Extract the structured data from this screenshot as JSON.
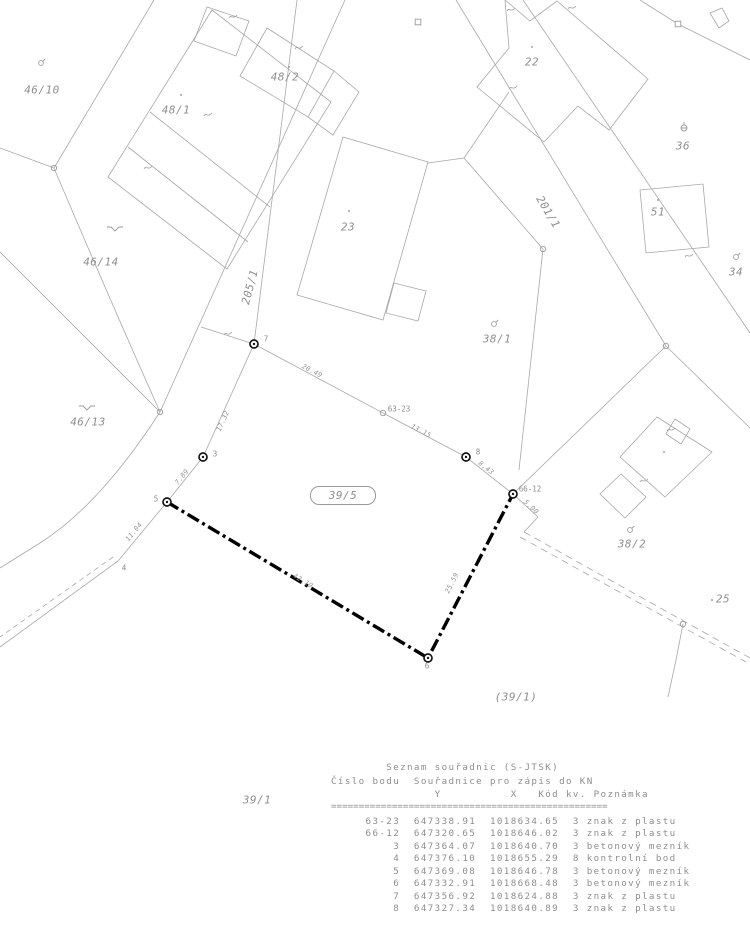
{
  "map": {
    "stadium": {
      "text": "39/5"
    },
    "parcel_labels": [
      {
        "text": "46/10",
        "x": 42,
        "y": 90
      },
      {
        "text": "48/1",
        "x": 176,
        "y": 110
      },
      {
        "text": "48/2",
        "x": 285,
        "y": 77
      },
      {
        "text": "22",
        "x": 532,
        "y": 62
      },
      {
        "text": "36",
        "x": 683,
        "y": 146
      },
      {
        "text": "23",
        "x": 348,
        "y": 227
      },
      {
        "text": "201/1",
        "x": 548,
        "y": 212,
        "rot": 59
      },
      {
        "text": "51",
        "x": 658,
        "y": 212
      },
      {
        "text": "34",
        "x": 736,
        "y": 272
      },
      {
        "text": "46/14",
        "x": 101,
        "y": 262
      },
      {
        "text": "205/1",
        "x": 250,
        "y": 287,
        "rot": -75
      },
      {
        "text": "38/1",
        "x": 497,
        "y": 339
      },
      {
        "text": "46/13",
        "x": 88,
        "y": 422
      },
      {
        "text": "38/2",
        "x": 632,
        "y": 544
      },
      {
        "text": "25",
        "x": 723,
        "y": 599
      },
      {
        "text": "(39/1)",
        "x": 516,
        "y": 697
      },
      {
        "text": "39/1",
        "x": 257,
        "y": 800
      }
    ],
    "measurement_labels": [
      {
        "text": "20.49",
        "x": 312,
        "y": 371,
        "rot": 28
      },
      {
        "text": "13.15",
        "x": 421,
        "y": 431,
        "rot": 28
      },
      {
        "text": "8.43",
        "x": 486,
        "y": 468,
        "rot": 38
      },
      {
        "text": "17.32",
        "x": 223,
        "y": 421,
        "rot": -66
      },
      {
        "text": "7.89",
        "x": 182,
        "y": 477,
        "rot": -51
      },
      {
        "text": "11.04",
        "x": 134,
        "y": 532,
        "rot": -51
      },
      {
        "text": "42.19",
        "x": 303,
        "y": 581,
        "rot": 31
      },
      {
        "text": "25.59",
        "x": 452,
        "y": 583,
        "rot": -63
      },
      {
        "text": "5.00",
        "x": 531,
        "y": 507,
        "rot": 43
      }
    ],
    "point_labels": [
      {
        "text": "7",
        "x": 266,
        "y": 339
      },
      {
        "text": "3",
        "x": 215,
        "y": 454
      },
      {
        "text": "5",
        "x": 156,
        "y": 499
      },
      {
        "text": "4",
        "x": 124,
        "y": 568
      },
      {
        "text": "6",
        "x": 427,
        "y": 666
      },
      {
        "text": "8",
        "x": 478,
        "y": 452
      },
      {
        "text": "63-23",
        "x": 399,
        "y": 409
      },
      {
        "text": "66-12",
        "x": 530,
        "y": 489
      }
    ],
    "points": [
      {
        "type": "bold",
        "x": 254,
        "y": 344
      },
      {
        "type": "bold",
        "x": 203,
        "y": 457
      },
      {
        "type": "bold",
        "x": 167,
        "y": 502
      },
      {
        "type": "bold",
        "x": 428,
        "y": 658
      },
      {
        "type": "bold",
        "x": 466,
        "y": 457
      },
      {
        "type": "bold",
        "x": 513,
        "y": 494
      },
      {
        "type": "circle",
        "x": 383,
        "y": 413
      },
      {
        "type": "circle",
        "x": 160,
        "y": 412
      },
      {
        "type": "circle",
        "x": 54,
        "y": 168
      },
      {
        "type": "circle",
        "x": 666,
        "y": 346
      },
      {
        "type": "circle",
        "x": 683,
        "y": 624
      },
      {
        "type": "circle",
        "x": 543,
        "y": 249
      },
      {
        "type": "square",
        "x": 418,
        "y": 22
      },
      {
        "type": "square",
        "x": 678,
        "y": 24
      },
      {
        "type": "dot",
        "x": 181,
        "y": 95
      },
      {
        "type": "dot",
        "x": 289,
        "y": 67
      },
      {
        "type": "dot",
        "x": 532,
        "y": 47
      },
      {
        "type": "dot",
        "x": 349,
        "y": 211
      },
      {
        "type": "dot",
        "x": 658,
        "y": 200
      },
      {
        "type": "dot",
        "x": 664,
        "y": 452
      },
      {
        "type": "dot",
        "x": 712,
        "y": 600
      }
    ],
    "symbols": [
      {
        "type": "garden",
        "x": 41,
        "y": 63
      },
      {
        "type": "garden",
        "x": 494,
        "y": 324
      },
      {
        "type": "garden",
        "x": 630,
        "y": 530
      },
      {
        "type": "garden",
        "x": 736,
        "y": 257
      },
      {
        "type": "well",
        "x": 684,
        "y": 128
      },
      {
        "type": "meadow",
        "x": 115,
        "y": 227
      },
      {
        "type": "meadow",
        "x": 87,
        "y": 406
      },
      {
        "type": "squiggle",
        "x": 233,
        "y": 17
      },
      {
        "type": "squiggle",
        "x": 299,
        "y": 48
      },
      {
        "type": "squiggle",
        "x": 208,
        "y": 115
      },
      {
        "type": "squiggle",
        "x": 148,
        "y": 168
      },
      {
        "type": "squiggle",
        "x": 228,
        "y": 334
      },
      {
        "type": "squiggle",
        "x": 511,
        "y": 10
      },
      {
        "type": "squiggle",
        "x": 572,
        "y": 8
      },
      {
        "type": "squiggle",
        "x": 513,
        "y": 88
      },
      {
        "type": "squiggle",
        "x": 689,
        "y": 256
      },
      {
        "type": "squiggle",
        "x": 671,
        "y": 430
      },
      {
        "type": "squiggle",
        "x": 644,
        "y": 481
      }
    ]
  },
  "table": {
    "title": "Seznam souřadnic (S-JTSK)",
    "header": "Číslo bodu  Souřadnice pro zápis do KN",
    "columns": [
      "Y",
      "X",
      "Kód kv.",
      "Poznámka"
    ],
    "rows": [
      {
        "bod": "63-23",
        "y": "647338.91",
        "x": "1018634.65",
        "kod": "3",
        "poznamka": "znak z plastu"
      },
      {
        "bod": "66-12",
        "y": "647320.65",
        "x": "1018646.02",
        "kod": "3",
        "poznamka": "znak z plastu"
      },
      {
        "bod": "3",
        "y": "647364.07",
        "x": "1018640.70",
        "kod": "3",
        "poznamka": "betonový mezník"
      },
      {
        "bod": "4",
        "y": "647376.10",
        "x": "1018655.29",
        "kod": "8",
        "poznamka": "kontrolní bod"
      },
      {
        "bod": "5",
        "y": "647369.08",
        "x": "1018646.78",
        "kod": "3",
        "poznamka": "betonový mezník"
      },
      {
        "bod": "6",
        "y": "647332.91",
        "x": "1018668.48",
        "kod": "3",
        "poznamka": "betonový mezník"
      },
      {
        "bod": "7",
        "y": "647356.92",
        "x": "1018624.88",
        "kod": "3",
        "poznamka": "znak z plastu"
      },
      {
        "bod": "8",
        "y": "647327.34",
        "x": "1018640.89",
        "kod": "3",
        "poznamka": "znak z plastu"
      }
    ]
  },
  "colors": {
    "thin_line": "#a8a8a8",
    "text": "#8e8e8e",
    "highlight_line": "#000000"
  }
}
